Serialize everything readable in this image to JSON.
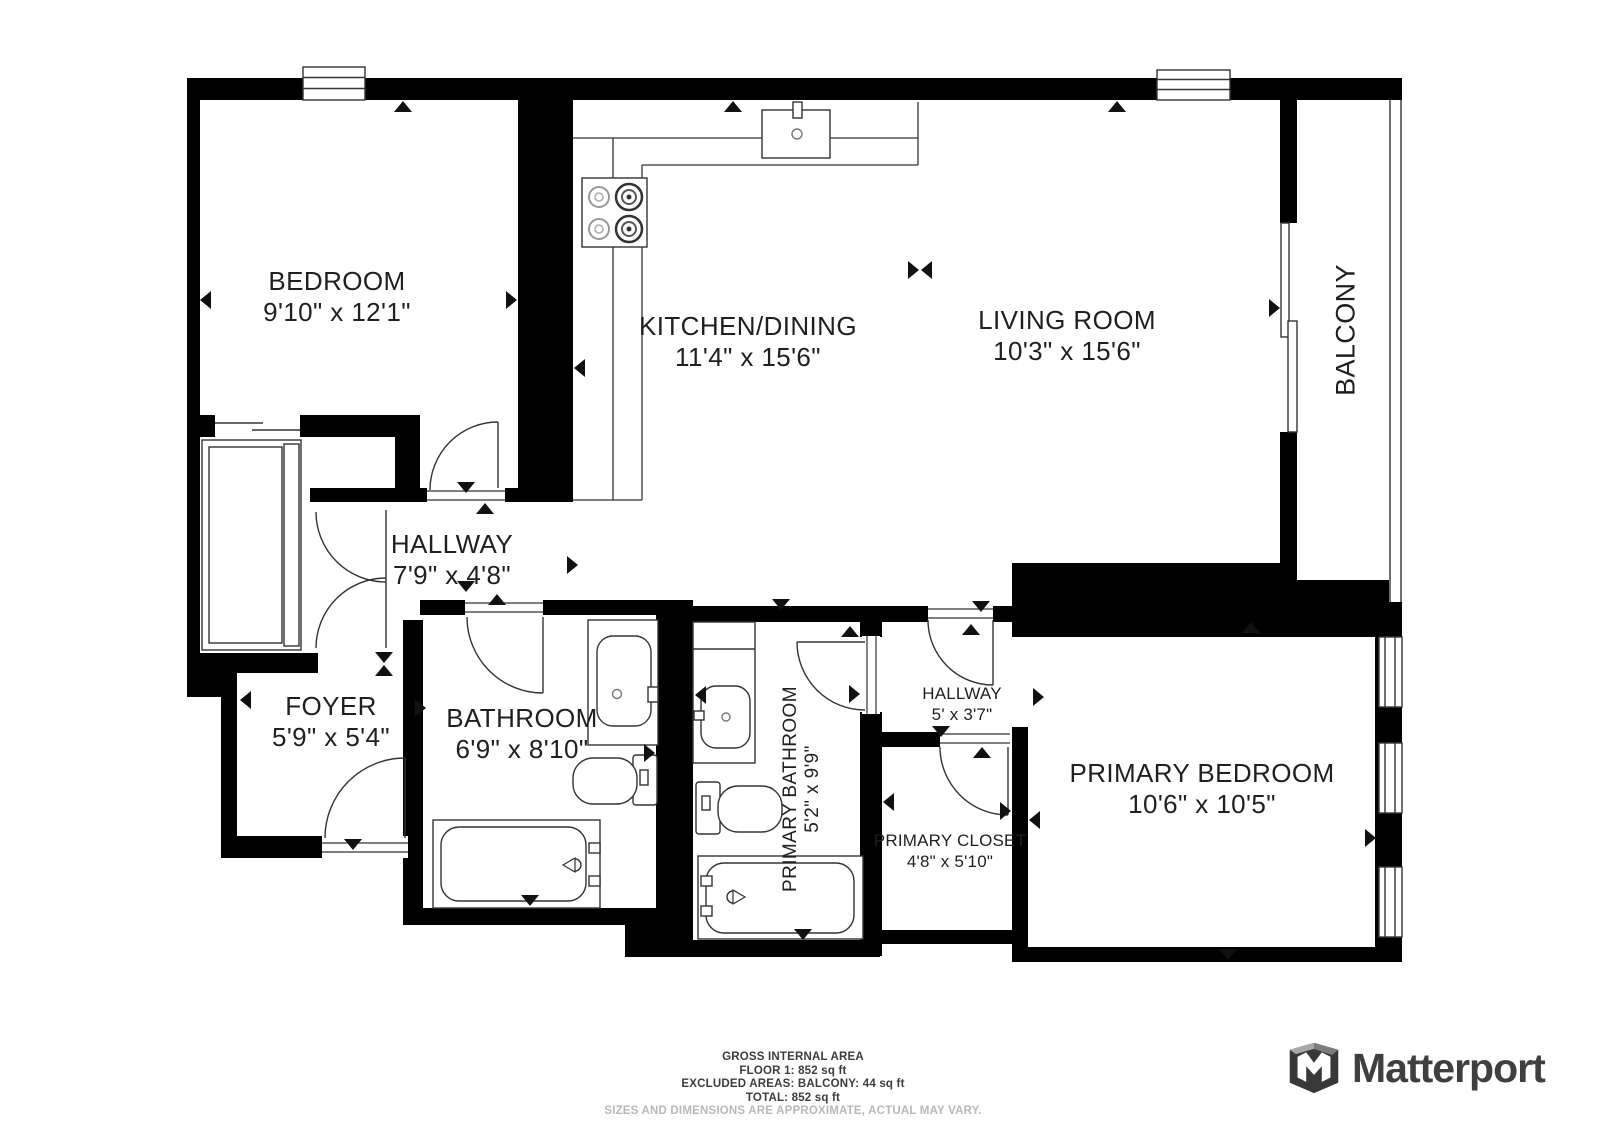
{
  "colors": {
    "background": "#ffffff",
    "walls": "#000000",
    "label_text": "#1f1f1f",
    "fixture_line": "#3a3a3a",
    "footer_text": "#3c3c3c",
    "disclaimer_text": "#b9b9b9",
    "brand_text": "#3f3f3f"
  },
  "rooms": [
    {
      "id": "bedroom",
      "label": "BEDROOM",
      "dims": "9'10\" x 12'1\""
    },
    {
      "id": "kitchen-dining",
      "label": "KITCHEN/DINING",
      "dims": "11'4\" x 15'6\""
    },
    {
      "id": "living-room",
      "label": "LIVING ROOM",
      "dims": "10'3\" x 15'6\""
    },
    {
      "id": "balcony",
      "label": "BALCONY",
      "dims": ""
    },
    {
      "id": "hallway",
      "label": "HALLWAY",
      "dims": "7'9\" x 4'8\""
    },
    {
      "id": "foyer",
      "label": "FOYER",
      "dims": "5'9\" x 5'4\""
    },
    {
      "id": "bathroom",
      "label": "BATHROOM",
      "dims": "6'9\" x 8'10\""
    },
    {
      "id": "primary-bathroom",
      "label": "PRIMARY BATHROOM",
      "dims": "5'2\" x 9'9\""
    },
    {
      "id": "hallway-2",
      "label": "HALLWAY",
      "dims": "5' x 3'7\""
    },
    {
      "id": "primary-closet",
      "label": "PRIMARY CLOSET",
      "dims": "4'8\" x 5'10\""
    },
    {
      "id": "primary-bedroom",
      "label": "PRIMARY BEDROOM",
      "dims": "10'6\" x 10'5\""
    }
  ],
  "footer": {
    "title": "GROSS INTERNAL AREA",
    "line1": "FLOOR 1: 852 sq ft",
    "line2": "EXCLUDED AREAS: BALCONY: 44 sq ft",
    "line3": "TOTAL: 852 sq ft",
    "disclaimer": "SIZES AND DIMENSIONS ARE APPROXIMATE, ACTUAL MAY VARY."
  },
  "brand": {
    "name": "Matterport"
  },
  "icons": [
    "stove-icon",
    "kitchen-sink-icon",
    "bathroom-sink-icon",
    "toilet-icon",
    "bathtub-icon",
    "wardrobe-icon",
    "door-swing-icon",
    "double-door-icon",
    "sliding-door-icon",
    "window-icon",
    "direction-arrow-icon",
    "matterport-logo-icon"
  ]
}
